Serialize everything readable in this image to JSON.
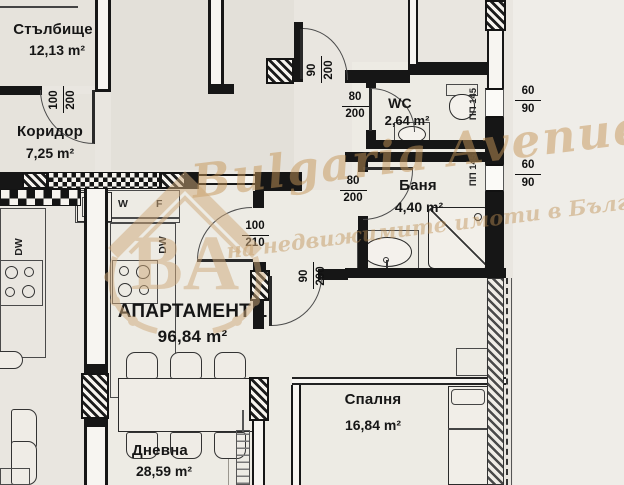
{
  "watermark": {
    "brand_script": "Bulgaria Avenue",
    "tagline": "на недвижимите имоти в България",
    "monogram": "BA"
  },
  "rooms": {
    "stairwell": {
      "name": "Стълбище",
      "area": "12,13 m²"
    },
    "corridor": {
      "name": "Коридор",
      "area": "7,25 m²"
    },
    "wc": {
      "name": "WC",
      "area": "2,64 m²"
    },
    "bath": {
      "name": "Баня",
      "area": "4,40 m²"
    },
    "apartment": {
      "name": "АПАРТАМЕНТ 1",
      "area": "96,84 m²"
    },
    "living": {
      "name": "Дневна",
      "area": "28,59 m²"
    },
    "bedroom": {
      "name": "Спалня",
      "area": "16,84 m²"
    }
  },
  "doors": {
    "stair": {
      "num": "100",
      "den": "200"
    },
    "entry": {
      "num": "90",
      "den": "200"
    },
    "wc": {
      "num": "80",
      "den": "200"
    },
    "bath": {
      "num": "80",
      "den": "200"
    },
    "living": {
      "num": "100",
      "den": "210"
    },
    "hall": {
      "num": "90",
      "den": "200"
    }
  },
  "windows": {
    "win1": {
      "num": "60",
      "den": "90",
      "mark": "ПП 145"
    },
    "win2": {
      "num": "60",
      "den": "90",
      "mark": "ПП 145"
    }
  },
  "appliances": {
    "dw_left": "DW",
    "dw_main": "DW",
    "washer": "W",
    "fridge": "F"
  },
  "colors": {
    "paper": "#e9e6e0",
    "ink": "#161616",
    "watermark_gold": "#cfa97a"
  }
}
